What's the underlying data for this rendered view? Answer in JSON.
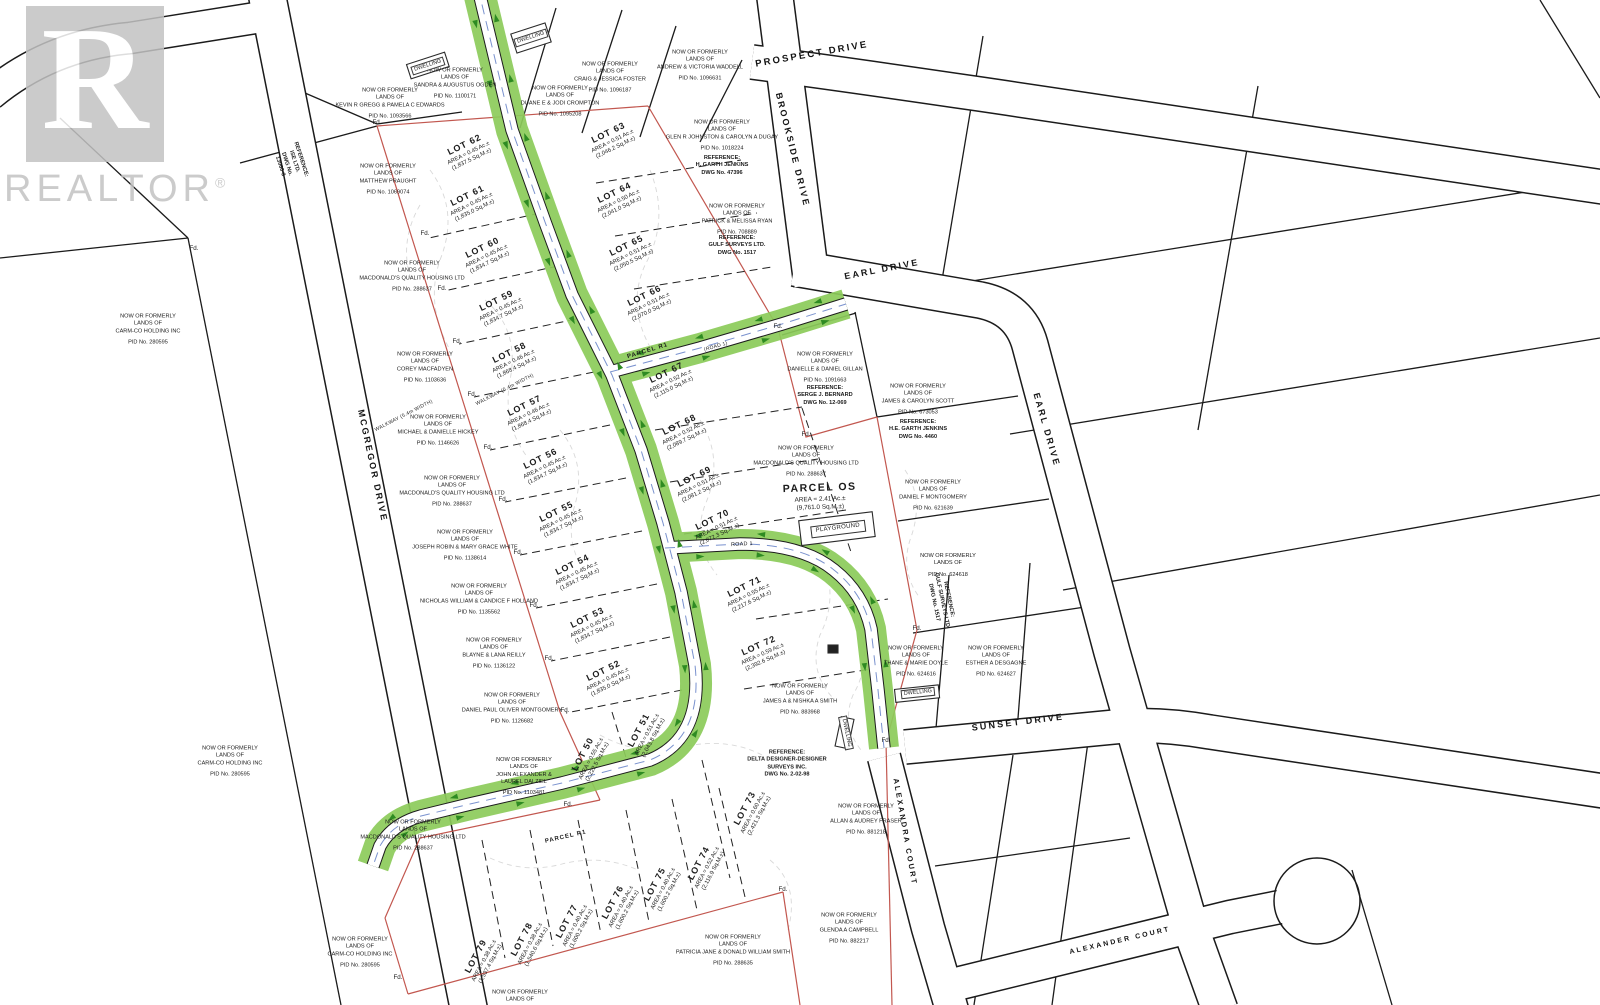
{
  "watermark": {
    "letter": "R",
    "text": "REALTOR",
    "registered": "®"
  },
  "fd_label": "Fd.",
  "colors": {
    "road_green": "#8ccb5a",
    "arrow_green": "#2e8b22",
    "boundary_red": "#c2574f",
    "line_black": "#1b1b1b",
    "contour_gray": "#cccccc",
    "watermark_gray": "#c3c3c3",
    "waterline_blue": "#6b86c9"
  },
  "streets": [
    {
      "name": "PROSPECT DRIVE",
      "x": 812,
      "y": 55,
      "rot": -10,
      "size": 9.5
    },
    {
      "name": "BROOKSIDE DRIVE",
      "x": 792,
      "y": 150,
      "rot": 76,
      "size": 9
    },
    {
      "name": "EARL DRIVE",
      "x": 882,
      "y": 270,
      "rot": -11,
      "size": 9
    },
    {
      "name": "EARL DRIVE",
      "x": 1046,
      "y": 430,
      "rot": 74,
      "size": 9
    },
    {
      "name": "SUNSET DRIVE",
      "x": 1018,
      "y": 723,
      "rot": -7,
      "size": 9
    },
    {
      "name": "ALEXANDRA COURT",
      "x": 905,
      "y": 832,
      "rot": 80,
      "size": 7.5
    },
    {
      "name": "ALEXANDER COURT",
      "x": 1120,
      "y": 941,
      "rot": -13,
      "size": 7
    },
    {
      "name": "MCGREGOR DRIVE",
      "x": 372,
      "y": 466,
      "rot": 78,
      "size": 9
    }
  ],
  "misc_labels": [
    {
      "text": "PARCEL R1",
      "x": 648,
      "y": 352,
      "rot": -17,
      "size": 6,
      "bold": true
    },
    {
      "text": "PARCEL R1",
      "x": 566,
      "y": 838,
      "rot": -13,
      "size": 6,
      "bold": true
    },
    {
      "text": "ROAD 1",
      "x": 742,
      "y": 545,
      "rot": -3,
      "size": 5.4,
      "bold": false
    },
    {
      "text": "(ROAD 1)",
      "x": 716,
      "y": 347,
      "rot": -16,
      "size": 5,
      "bold": false
    },
    {
      "text": "WALKWAY (5.4m WIDTH)",
      "x": 505,
      "y": 390,
      "rot": -27,
      "size": 5,
      "bold": false
    },
    {
      "text": "WALKWAY (5.4m WIDTH)",
      "x": 404,
      "y": 416,
      "rot": -27,
      "size": 5,
      "bold": false
    },
    {
      "text": "PLAYGROUND",
      "x": 838,
      "y": 529,
      "rot": -7,
      "size": 6,
      "bold": false,
      "boxed": true
    }
  ],
  "lots": [
    {
      "num": "LOT 62",
      "ac": "AREA = 0.45 Ac.±",
      "sqm": "(1,837.5 Sq.M.±)",
      "x": 468,
      "y": 152,
      "rot": -26
    },
    {
      "num": "LOT 63",
      "ac": "AREA = 0.51 Ac.±",
      "sqm": "(2,046.2 Sq.M.±)",
      "x": 612,
      "y": 140,
      "rot": -26
    },
    {
      "num": "LOT 61",
      "ac": "AREA = 0.45 Ac.±",
      "sqm": "(1,835.0 Sq.M.±)",
      "x": 471,
      "y": 203,
      "rot": -26
    },
    {
      "num": "LOT 64",
      "ac": "AREA = 0.50 Ac.±",
      "sqm": "(2,041.0 Sq.M.±)",
      "x": 618,
      "y": 200,
      "rot": -26
    },
    {
      "num": "LOT 60",
      "ac": "AREA = 0.45 Ac.±",
      "sqm": "(1,834.7 Sq.M.±)",
      "x": 486,
      "y": 255,
      "rot": -26
    },
    {
      "num": "LOT 65",
      "ac": "AREA = 0.51 Ac.±",
      "sqm": "(2,050.5 Sq.M.±)",
      "x": 630,
      "y": 253,
      "rot": -26
    },
    {
      "num": "LOT 59",
      "ac": "AREA = 0.45 Ac.±",
      "sqm": "(1,834.7 Sq.M.±)",
      "x": 500,
      "y": 308,
      "rot": -26
    },
    {
      "num": "LOT 66",
      "ac": "AREA = 0.51 Ac.±",
      "sqm": "(2,070.0 Sq.M.±)",
      "x": 648,
      "y": 303,
      "rot": -26
    },
    {
      "num": "LOT 58",
      "ac": "AREA = 0.46 Ac.±",
      "sqm": "(1,868.4 Sq.M.±)",
      "x": 513,
      "y": 360,
      "rot": -26
    },
    {
      "num": "LOT 67",
      "ac": "AREA = 0.52 Ac.±",
      "sqm": "(2,115.0 Sq.M.±)",
      "x": 670,
      "y": 380,
      "rot": -26
    },
    {
      "num": "LOT 57",
      "ac": "AREA = 0.46 Ac.±",
      "sqm": "(1,868.4 Sq.M.±)",
      "x": 528,
      "y": 413,
      "rot": -26
    },
    {
      "num": "LOT 68",
      "ac": "AREA = 0.52 Ac.±",
      "sqm": "(2,089.7 Sq.M.±)",
      "x": 683,
      "y": 432,
      "rot": -26
    },
    {
      "num": "LOT 56",
      "ac": "AREA = 0.45 Ac.±",
      "sqm": "(1,834.7 Sq.M.±)",
      "x": 544,
      "y": 466,
      "rot": -26
    },
    {
      "num": "LOT 69",
      "ac": "AREA = 0.51 Ac.±",
      "sqm": "(2,081.2 Sq.M.±)",
      "x": 698,
      "y": 484,
      "rot": -26
    },
    {
      "num": "LOT 55",
      "ac": "AREA = 0.45 Ac.±",
      "sqm": "(1,834.7 Sq.M.±)",
      "x": 560,
      "y": 519,
      "rot": -26
    },
    {
      "num": "LOT 70",
      "ac": "AREA = 0.51 Ac.±",
      "sqm": "(2,072.3 Sq.M.±)",
      "x": 716,
      "y": 527,
      "rot": -26
    },
    {
      "num": "LOT 54",
      "ac": "AREA = 0.45 Ac.±",
      "sqm": "(1,834.7 Sq.M.±)",
      "x": 576,
      "y": 572,
      "rot": -26
    },
    {
      "num": "LOT 71",
      "ac": "AREA = 0.55 Ac.±",
      "sqm": "(2,217.6 Sq.M.±)",
      "x": 748,
      "y": 594,
      "rot": -26
    },
    {
      "num": "LOT 53",
      "ac": "AREA = 0.45 Ac.±",
      "sqm": "(1,834.7 Sq.M.±)",
      "x": 591,
      "y": 625,
      "rot": -26
    },
    {
      "num": "LOT 72",
      "ac": "AREA = 0.59 Ac.±",
      "sqm": "(2,392.6 Sq.M.±)",
      "x": 762,
      "y": 653,
      "rot": -24
    },
    {
      "num": "LOT 52",
      "ac": "AREA = 0.45 Ac.±",
      "sqm": "(1,835.0 Sq.M.±)",
      "x": 607,
      "y": 678,
      "rot": -26
    },
    {
      "num": "LOT 51",
      "ac": "AREA = 0.51 Ac.±",
      "sqm": "(2,043.8 Sq.M.±)",
      "x": 646,
      "y": 734,
      "rot": -62
    },
    {
      "num": "LOT 50",
      "ac": "AREA = 0.55 Ac.±",
      "sqm": "(2,222.5 Sq.M.±)",
      "x": 590,
      "y": 758,
      "rot": -62
    },
    {
      "num": "LOT 73",
      "ac": "AREA = 0.60 Ac.±",
      "sqm": "(2,421.3 Sq.M.±)",
      "x": 752,
      "y": 812,
      "rot": -62
    },
    {
      "num": "LOT 74",
      "ac": "AREA = 0.52 Ac.±",
      "sqm": "(2,116.9 Sq.M.±)",
      "x": 706,
      "y": 867,
      "rot": -62
    },
    {
      "num": "LOT 75",
      "ac": "AREA = 0.40 Ac.±",
      "sqm": "(1,600.2 Sq.M.±)",
      "x": 662,
      "y": 888,
      "rot": -62
    },
    {
      "num": "LOT 76",
      "ac": "AREA = 0.40 Ac.±",
      "sqm": "(1,600.2 Sq.M.±)",
      "x": 620,
      "y": 906,
      "rot": -62
    },
    {
      "num": "LOT 77",
      "ac": "AREA = 0.40 Ac.±",
      "sqm": "(1,600.2 Sq.M.±)",
      "x": 574,
      "y": 925,
      "rot": -62
    },
    {
      "num": "LOT 78",
      "ac": "AREA = 0.38 Ac.±",
      "sqm": "(1,540.6 Sq.M.±)",
      "x": 529,
      "y": 943,
      "rot": -62
    },
    {
      "num": "LOT 79",
      "ac": "AREA = 0.38 Ac.±",
      "sqm": "(1,537.4 Sq.M.±)",
      "x": 483,
      "y": 960,
      "rot": -62
    }
  ],
  "parcel_os": {
    "num": "PARCEL OS",
    "ac": "AREA = 2.41 Ac.±",
    "sqm": "(9,761.0 Sq.M.±)",
    "x": 820,
    "y": 497,
    "rot": -2
  },
  "owners": [
    {
      "x": 390,
      "y": 104,
      "lines": [
        "NOW OR FORMERLY",
        "LANDS OF",
        "KEVIN R GREGG & PAMELA C EDWARDS"
      ],
      "pid": "PID No. 1093566"
    },
    {
      "x": 455,
      "y": 84,
      "lines": [
        "NOW OR FORMERLY",
        "LANDS OF",
        "SANDRA & AUGUSTUS OGDEN"
      ],
      "pid": "PID No. 1100171"
    },
    {
      "x": 560,
      "y": 102,
      "lines": [
        "NOW OR FORMERLY",
        "LANDS OF",
        "DUANE E & JODI CROMPTON"
      ],
      "pid": "PID No. 1095208"
    },
    {
      "x": 610,
      "y": 78,
      "lines": [
        "NOW OR FORMERLY",
        "LANDS OF",
        "CRAIG & JESSICA FOSTER"
      ],
      "pid": "PID No. 1096187"
    },
    {
      "x": 700,
      "y": 66,
      "lines": [
        "NOW OR FORMERLY",
        "LANDS OF",
        "ANDREW & VICTORIA WADDELL"
      ],
      "pid": "PID No. 1096631"
    },
    {
      "x": 388,
      "y": 180,
      "lines": [
        "NOW OR FORMERLY",
        "LANDS OF",
        "MATTHEW PRAUGHT"
      ],
      "pid": "PID No. 1069074"
    },
    {
      "x": 722,
      "y": 136,
      "lines": [
        "NOW OR FORMERLY",
        "LANDS OF",
        "GLEN R JOHNSTON & CAROLYN A DUGAY"
      ],
      "pid": "PID No. 1018224"
    },
    {
      "x": 737,
      "y": 220,
      "lines": [
        "NOW OR FORMERLY",
        "LANDS OF",
        "PATRICK & MELISSA RYAN"
      ],
      "pid": "PID No. 708889"
    },
    {
      "x": 412,
      "y": 277,
      "lines": [
        "NOW OR FORMERLY",
        "LANDS OF",
        "MACDONALD'S QUALITY HOUSING LTD"
      ],
      "pid": "PID No. 288637"
    },
    {
      "x": 425,
      "y": 368,
      "lines": [
        "NOW OR FORMERLY",
        "LANDS OF",
        "COREY MACFADYEN"
      ],
      "pid": "PID No. 1103636"
    },
    {
      "x": 438,
      "y": 431,
      "lines": [
        "NOW OR FORMERLY",
        "LANDS OF",
        "MICHAEL & DANIELLE HICKEY"
      ],
      "pid": "PID No. 1146626"
    },
    {
      "x": 452,
      "y": 492,
      "lines": [
        "NOW OR FORMERLY",
        "LANDS OF",
        "MACDONALD'S QUALITY HOUSING LTD"
      ],
      "pid": "PID No. 288637"
    },
    {
      "x": 465,
      "y": 546,
      "lines": [
        "NOW OR FORMERLY",
        "LANDS OF",
        "JOSEPH ROBIN & MARY GRACE WHITE"
      ],
      "pid": "PID No. 1138614"
    },
    {
      "x": 479,
      "y": 600,
      "lines": [
        "NOW OR FORMERLY",
        "LANDS OF",
        "NICHOLAS WILLIAM & CANDICE F HOLLAND"
      ],
      "pid": "PID No. 1135562"
    },
    {
      "x": 494,
      "y": 654,
      "lines": [
        "NOW OR FORMERLY",
        "LANDS OF",
        "BLAYNE & LANA REILLY"
      ],
      "pid": "PID No. 1136122"
    },
    {
      "x": 512,
      "y": 709,
      "lines": [
        "NOW OR FORMERLY",
        "LANDS OF",
        "DANIEL PAUL OLIVER MONTGOMERY"
      ],
      "pid": "PID No. 1126682"
    },
    {
      "x": 524,
      "y": 777,
      "lines": [
        "NOW OR FORMERLY",
        "LANDS OF",
        "JOHN ALEXANDER &",
        "LAUREL DALZIEL"
      ],
      "pid": "PID No. 1103481"
    },
    {
      "x": 413,
      "y": 836,
      "lines": [
        "NOW OR FORMERLY",
        "LANDS OF",
        "MACDONALD'S QUALITY HOUSING LTD"
      ],
      "pid": "PID No. 288637"
    },
    {
      "x": 148,
      "y": 330,
      "lines": [
        "NOW OR FORMERLY",
        "LANDS OF",
        "CARM-CO HOLDING INC"
      ],
      "pid": "PID No. 280595"
    },
    {
      "x": 230,
      "y": 762,
      "lines": [
        "NOW OR FORMERLY",
        "LANDS OF",
        "CARM-CO HOLDING INC"
      ],
      "pid": "PID No. 280595"
    },
    {
      "x": 360,
      "y": 953,
      "lines": [
        "NOW OR FORMERLY",
        "LANDS OF",
        "CARM-CO HOLDING INC"
      ],
      "pid": "PID No. 280595"
    },
    {
      "x": 825,
      "y": 368,
      "lines": [
        "NOW OR FORMERLY",
        "LANDS OF",
        "DANIELLE & DANIEL GILLAN"
      ],
      "pid": "PID No. 1091663"
    },
    {
      "x": 918,
      "y": 400,
      "lines": [
        "NOW OR FORMERLY",
        "LANDS OF",
        "JAMES & CAROLYN SCOTT"
      ],
      "pid": "PID No. 673053"
    },
    {
      "x": 806,
      "y": 462,
      "lines": [
        "NOW OR FORMERLY",
        "LANDS OF",
        "MACDONALD'S QUALITY HOUSING LTD"
      ],
      "pid": "PID No. 288637"
    },
    {
      "x": 933,
      "y": 496,
      "lines": [
        "NOW OR FORMERLY",
        "LANDS OF",
        "DANIEL F MONTGOMERY"
      ],
      "pid": "PID No. 621639"
    },
    {
      "x": 948,
      "y": 566,
      "lines": [
        "NOW OR FORMERLY",
        "LANDS OF"
      ],
      "pid": "PID No. 624618"
    },
    {
      "x": 916,
      "y": 662,
      "lines": [
        "NOW OR FORMERLY",
        "LANDS OF",
        "THANE & MARIE DOYLE"
      ],
      "pid": "PID No. 624616"
    },
    {
      "x": 996,
      "y": 662,
      "lines": [
        "NOW OR FORMERLY",
        "LANDS OF",
        "ESTHER A DESGAGNE"
      ],
      "pid": "PID No. 624627"
    },
    {
      "x": 800,
      "y": 700,
      "lines": [
        "NOW OR FORMERLY",
        "LANDS OF",
        "JAMES A & NISHKA A SMITH"
      ],
      "pid": "PID No. 883968"
    },
    {
      "x": 866,
      "y": 820,
      "lines": [
        "NOW OR FORMERLY",
        "LANDS OF",
        "ALLAN & AUDREY FRASER"
      ],
      "pid": "PID No. 881218"
    },
    {
      "x": 849,
      "y": 929,
      "lines": [
        "NOW OR FORMERLY",
        "LANDS OF",
        "GLENDA A CAMPBELL"
      ],
      "pid": "PID No. 882217"
    },
    {
      "x": 733,
      "y": 951,
      "lines": [
        "NOW OR FORMERLY",
        "LANDS OF",
        "PATRICIA JANE & DONALD WILLIAM SMITH"
      ],
      "pid": "PID No. 288635"
    },
    {
      "x": 520,
      "y": 997,
      "lines": [
        "NOW OR FORMERLY",
        "LANDS OF"
      ],
      "pid": ""
    }
  ],
  "references": [
    {
      "x": 722,
      "y": 166,
      "rot": 0,
      "lines": [
        "REFERENCE:",
        "H. GARTH JENKINS",
        "DWG No. 47396"
      ]
    },
    {
      "x": 737,
      "y": 246,
      "rot": 0,
      "lines": [
        "REFERENCE:",
        "GULF SURVEYS LTD.",
        "DWG No. 1517"
      ]
    },
    {
      "x": 825,
      "y": 396,
      "rot": 0,
      "lines": [
        "REFERENCE:",
        "SERGE J. BERNARD",
        "DWG No. 12-069"
      ]
    },
    {
      "x": 918,
      "y": 430,
      "rot": 0,
      "lines": [
        "REFERENCE:",
        "H.E. GARTH JENKINS",
        "DWG No. 4460"
      ]
    },
    {
      "x": 787,
      "y": 764,
      "rot": 0,
      "lines": [
        "REFERENCE:",
        "DELTA DESIGNER-DESIGNER",
        "SURVEYS INC.",
        "DWG No. 2-02-98"
      ]
    },
    {
      "x": 290,
      "y": 163,
      "rot": 72,
      "lines": [
        "REFERENCE:",
        "ISE LTD.",
        "DWG No.",
        "13060-3"
      ]
    },
    {
      "x": 941,
      "y": 601,
      "rot": 78,
      "lines": [
        "REFERENCE:",
        "GULF SURVEYS LTD.",
        "DWG No. 1517"
      ]
    }
  ],
  "dwellings": [
    {
      "label": "DWELLING",
      "x": 428,
      "y": 66,
      "rot": -18
    },
    {
      "label": "DWELLING",
      "x": 531,
      "y": 38,
      "rot": -18
    },
    {
      "label": "DWELLING",
      "x": 918,
      "y": 693,
      "rot": -6
    },
    {
      "label": "DWELLING",
      "x": 846,
      "y": 733,
      "rot": 78
    }
  ],
  "fd_points": [
    [
      377,
      123
    ],
    [
      425,
      234
    ],
    [
      442,
      289
    ],
    [
      457,
      342
    ],
    [
      472,
      395
    ],
    [
      488,
      448
    ],
    [
      503,
      500
    ],
    [
      518,
      553
    ],
    [
      534,
      606
    ],
    [
      549,
      659
    ],
    [
      565,
      711
    ],
    [
      568,
      805
    ],
    [
      398,
      978
    ],
    [
      783,
      890
    ],
    [
      778,
      327
    ],
    [
      806,
      435
    ],
    [
      917,
      629
    ],
    [
      886,
      741
    ],
    [
      194,
      249
    ]
  ]
}
